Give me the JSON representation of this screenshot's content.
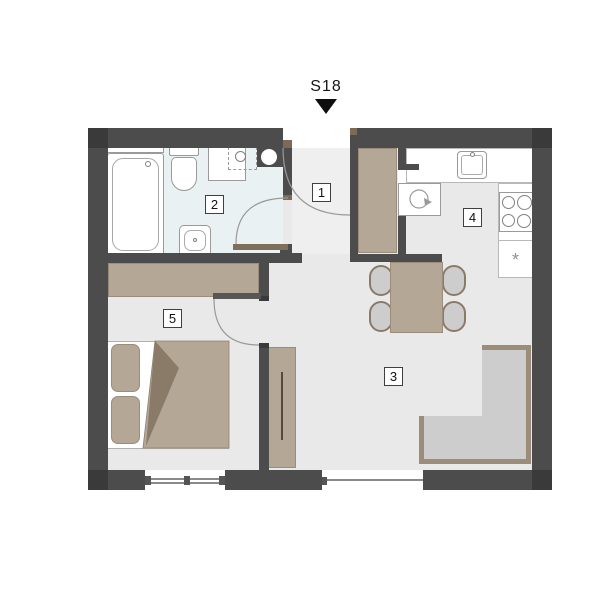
{
  "title": "S18",
  "rooms": [
    {
      "label": "1"
    },
    {
      "label": "2"
    },
    {
      "label": "3"
    },
    {
      "label": "4"
    },
    {
      "label": "5"
    }
  ],
  "kitchen": {
    "freezer_symbol": "*"
  },
  "colors": {
    "wall": "#4c4c4c",
    "wall-dark": "#3a3a3a",
    "frame-brown": "#7c6b57",
    "door-leaf": "#7e6f5c",
    "floor": "#e9e9e9",
    "floor-bath": "#eaf1f2",
    "floor-hall": "#efefef",
    "tan": "#b5a795",
    "tan-dark": "#9b8d7b",
    "tan-deep": "#8a7b69",
    "seat-gray": "#cdcdcd",
    "sofa-tan": "#9c8d7b",
    "line-gray": "#999999"
  }
}
